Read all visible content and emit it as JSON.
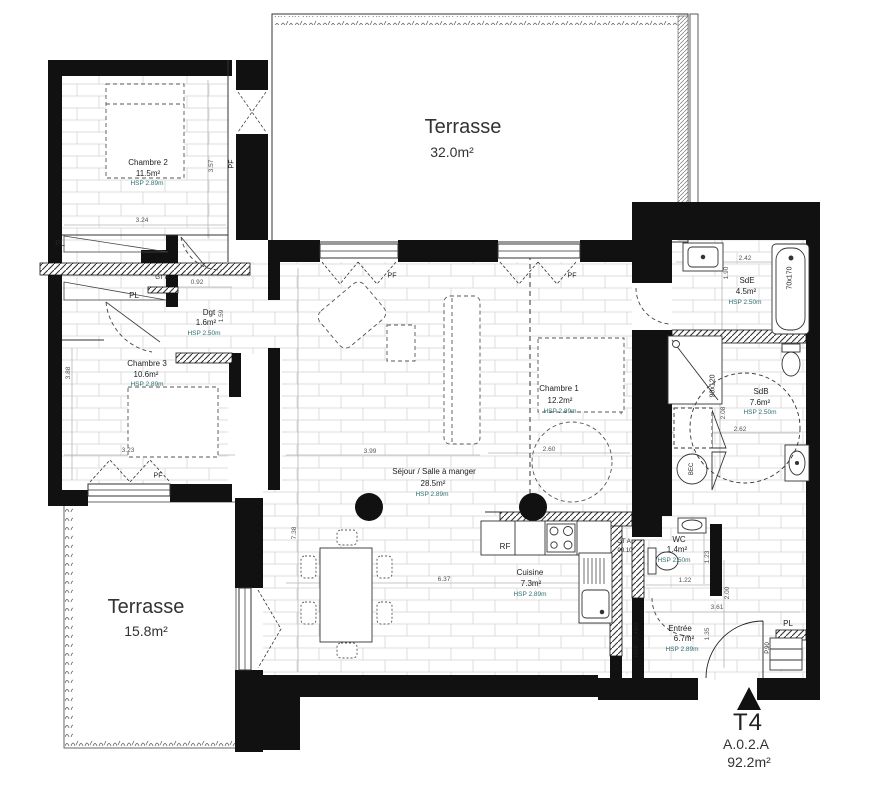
{
  "unit": {
    "type": "T4",
    "ref": "A.0.2.A",
    "total_area": "92.2m²"
  },
  "rooms": {
    "terrasse_top": {
      "name": "Terrasse",
      "area": "32.0m²"
    },
    "terrasse_bottom": {
      "name": "Terrasse",
      "area": "15.8m²"
    },
    "chambre1": {
      "name": "Chambre 1",
      "area": "12.2m²",
      "hsp": "HSP 2.89m"
    },
    "chambre2": {
      "name": "Chambre 2",
      "area": "11.5m²",
      "hsp": "HSP 2.89m"
    },
    "chambre3": {
      "name": "Chambre 3",
      "area": "10.6m²",
      "hsp": "HSP 2.89m"
    },
    "sejour": {
      "name": "Séjour / Salle à manger",
      "area": "28.5m²",
      "hsp": "HSP 2.89m"
    },
    "cuisine": {
      "name": "Cuisine",
      "area": "7.3m²",
      "hsp": "HSP 2.89m"
    },
    "dgt": {
      "name": "Dgt",
      "area": "1.6m²",
      "hsp": "HSP 2.50m"
    },
    "sde": {
      "name": "SdE",
      "area": "4.5m²",
      "hsp": "HSP 2.50m"
    },
    "sdb": {
      "name": "SdB",
      "area": "7.6m²",
      "hsp": "HSP 2.50m"
    },
    "wc": {
      "name": "WC",
      "area": "1.4m²",
      "hsp": "HSP 2.50m"
    },
    "entree": {
      "name": "Entrée",
      "area": "6.7m²",
      "hsp": "HSP 2.89m"
    }
  },
  "tags": {
    "pf": "PF",
    "pl": "PL",
    "gt": "GT A",
    "gt_num": "00.10",
    "rf": "RF",
    "bec": "BEC",
    "bathtub_size": "70x170",
    "shower_size": "90x120",
    "door_ref": "P.90",
    "hsp_beam": "HSP : 2.44m"
  },
  "dims": {
    "d1": "3.57",
    "d2": "3.24",
    "d3": "0.92",
    "d4": "1.59",
    "d5": "3.88",
    "d6": "3.23",
    "d7": "3.99",
    "d8": "2.60",
    "d9": "6.37",
    "d10": "7.38",
    "d11": "2.42",
    "d12": "1.90",
    "d13": "2.62",
    "d14": "2.08",
    "d15": "1.22",
    "d16": "1.23",
    "d17": "2.00",
    "d18": "3.61",
    "d19": "1.35"
  },
  "colors": {
    "wall": "#111111",
    "hsp_text": "#2f6f6f",
    "dim_text": "#555555"
  }
}
